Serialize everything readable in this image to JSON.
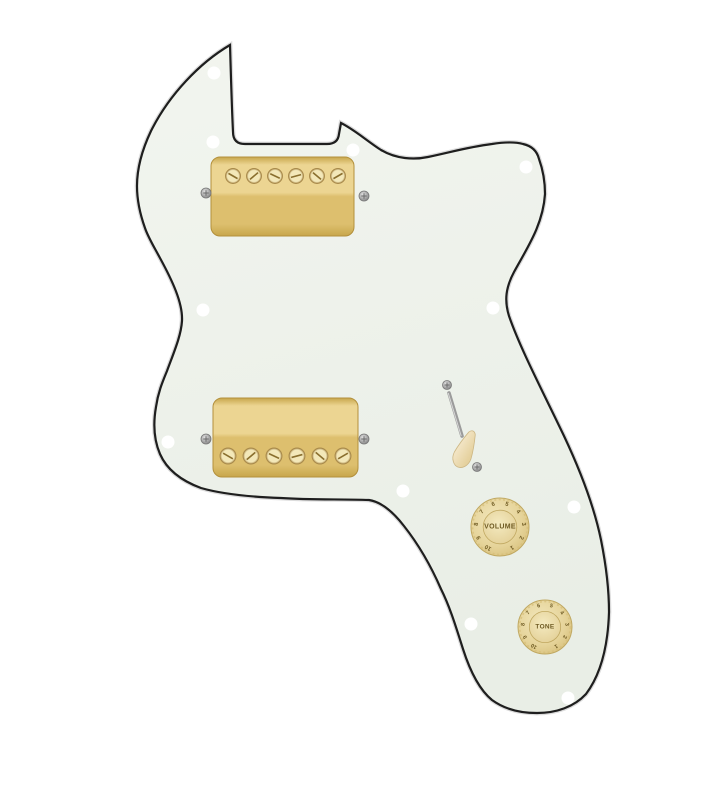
{
  "scene": {
    "canvas": {
      "width": 720,
      "height": 800,
      "background": "#ffffff"
    },
    "pickguard": {
      "description": "thinline-tele-style-pickguard",
      "fill_top": "#f2f5ef",
      "fill_bottom": "#e9eee6",
      "edge_color": "#1e1e1e",
      "edge_halo": "#9a9a9a",
      "edge_width": 2.2,
      "outline_path": "M230,45 C231,80 232,112 233,132 Q233,144 245,144 L327,144 Q338,144 339,134 L341,123 C355,130 367,141 381,150 C396,159 414,160 428,157 C452,152 468,147 492,144 C505,142 516,142 523,144 C532,146 537,151 539,159 C543,170 545,182 545,194 C543,225 527,248 514,272 C506,287 504,300 509,316 C520,348 543,392 564,436 C580,470 594,506 601,540 C606,565 609,588 609,612 C608,645 601,674 586,694 C574,707 556,713 537,713 C518,713 503,708 492,700 C481,691 471,674 463,649 C456,627 450,607 441,589 C431,566 419,545 404,526 C394,513 382,502 369,500 C340,499 310,500 281,498 C253,497 222,494 201,488 C182,481 167,470 160,454 C154,440 153,424 156,407 C158,393 162,383 167,371 C174,352 181,336 182,321 C183,303 172,280 160,258 C153,245 148,237 145,228 C140,214 137,200 137,186 C137,168 142,150 151,131 C160,113 172,96 186,81 C199,67 213,55 230,45 Z"
    },
    "mount_holes": {
      "color": "#ffffff",
      "radius": 6.5,
      "positions": [
        [
          214,
          73
        ],
        [
          213,
          142
        ],
        [
          353,
          150
        ],
        [
          526,
          167
        ],
        [
          203,
          310
        ],
        [
          493,
          308
        ],
        [
          168,
          442
        ],
        [
          403,
          491
        ],
        [
          574,
          507
        ],
        [
          471,
          624
        ],
        [
          568,
          698
        ]
      ]
    },
    "pickups": {
      "gold_dark": "#c7a64b",
      "gold_mid": "#ddbf6e",
      "gold_light": "#ecd592",
      "gold_edge": "#b3903c",
      "pole_fill": "#f3e8b9",
      "pole_rim": "#a8894a",
      "pole_slot": "#8a6f2e",
      "neck": {
        "x": 211,
        "y": 157,
        "w": 143,
        "h": 79,
        "rx": 9,
        "pole_y": 176,
        "pole_xs": [
          233,
          254,
          275,
          296,
          317,
          338
        ],
        "pole_r": 7.5,
        "screws": [
          [
            206,
            193
          ],
          [
            364,
            196
          ]
        ]
      },
      "bridge": {
        "x": 213,
        "y": 398,
        "w": 145,
        "h": 79,
        "rx": 9,
        "pole_y": 456,
        "pole_xs": [
          228,
          251,
          274,
          297,
          320,
          343
        ],
        "pole_r": 8,
        "screws": [
          [
            206,
            439
          ],
          [
            364,
            439
          ]
        ]
      }
    },
    "screw_colors": {
      "light": "#e2e2e2",
      "dark": "#969696",
      "rim": "#787878",
      "cross": "#6a6a6a",
      "radius": 5
    },
    "switch": {
      "screw_top": [
        447,
        385
      ],
      "screw_bottom": [
        477,
        467
      ],
      "screw_r": 4.5,
      "shaft": {
        "x1": 449,
        "y1": 393,
        "x2": 462,
        "y2": 436,
        "color": "#9b9b9b",
        "highlight": "#d8d8d8"
      },
      "tip": {
        "cx": 465,
        "cy": 450,
        "angle": 23,
        "fill_light": "#f6ead0",
        "fill_dark": "#e5d19e",
        "edge": "#cdb784"
      }
    },
    "knobs": {
      "skirt_light": "#f2e7bd",
      "skirt_mid": "#e6d49a",
      "skirt_dark": "#d5bd77",
      "edge": "#c0a861",
      "face_light": "#f4eac0",
      "face_dark": "#e4d199",
      "text_color": "#6e5a22",
      "numbers": [
        "1",
        "2",
        "3",
        "4",
        "5",
        "6",
        "7",
        "8",
        "9",
        "10"
      ],
      "volume": {
        "label": "VOLUME",
        "cx": 500,
        "cy": 527,
        "r": 29
      },
      "tone": {
        "label": "TONE",
        "cx": 545,
        "cy": 627,
        "r": 27
      }
    }
  }
}
